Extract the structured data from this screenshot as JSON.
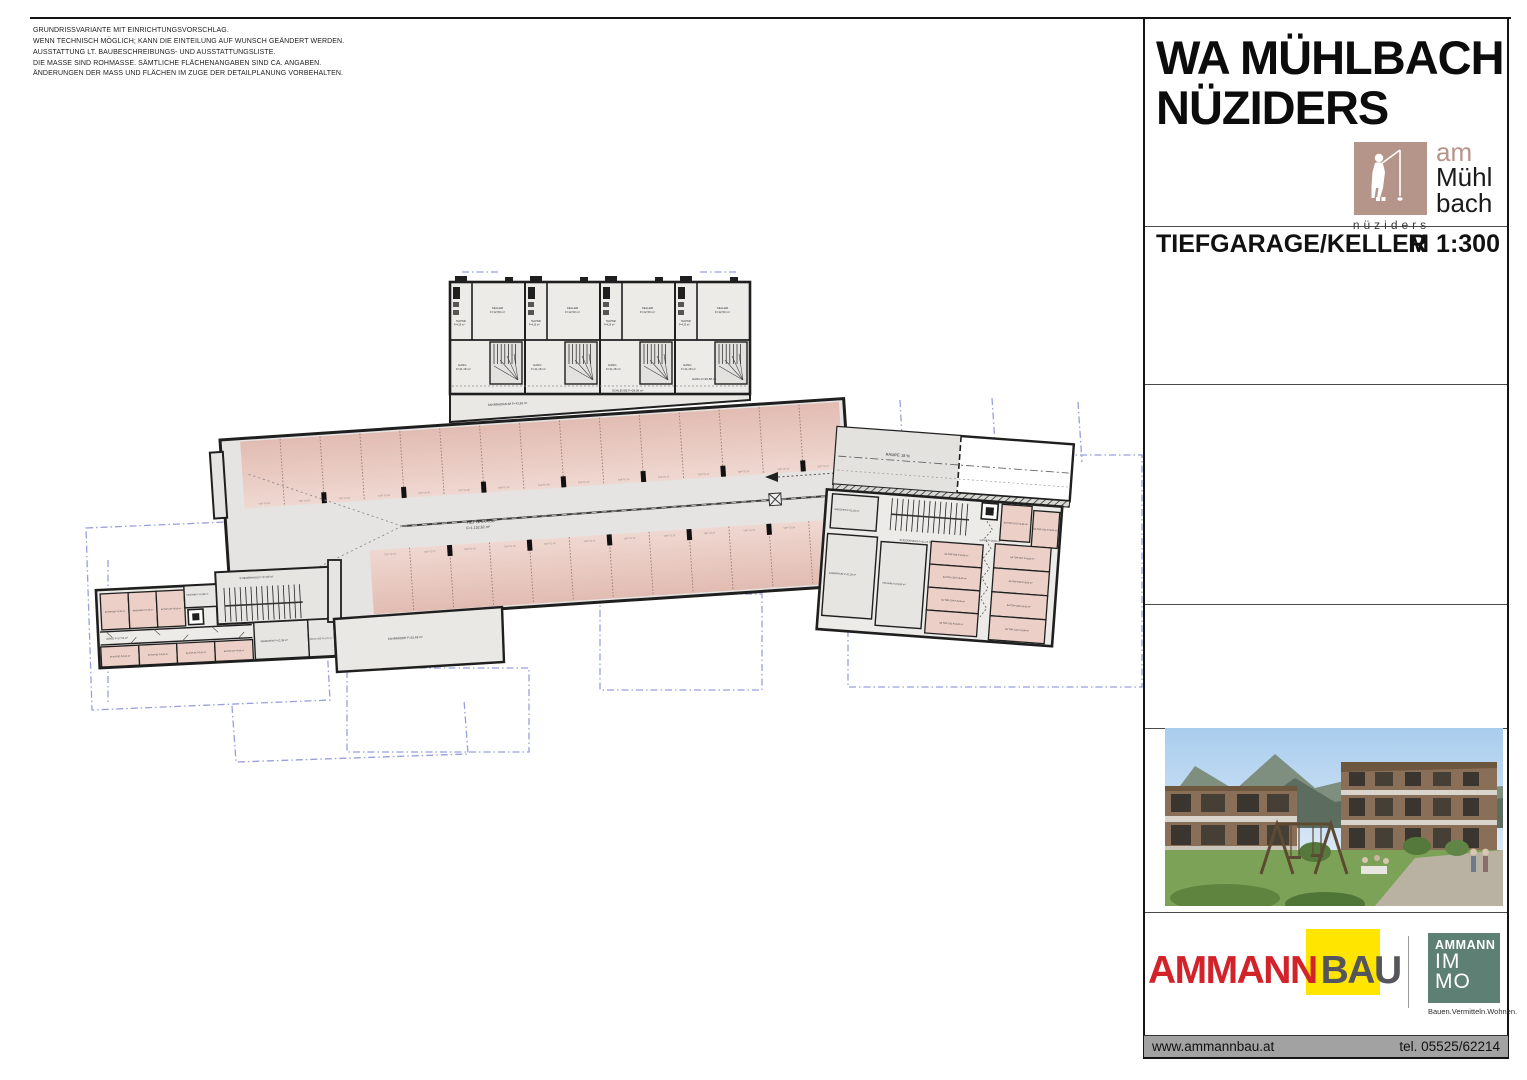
{
  "notes": {
    "lines": [
      "GRUNDRISSVARIANTE MIT EINRICHTUNGSVORSCHLAG.",
      "WENN TECHNISCH MÖGLICH; KANN DIE EINTEILUNG AUF WUNSCH GEÄNDERT WERDEN.",
      "AUSSTATTUNG LT. BAUBESCHREIBUNGS- UND AUSSTATTUNGSLISTE.",
      "DIE MASSE SIND ROHMASSE. SÄMTLICHE FLÄCHENANGABEN SIND CA. ANGABEN.",
      "ÄNDERUNGEN DER MASS UND FLÄCHEN IM ZUGE DER DETAILPLANUNG VORBEHALTEN."
    ]
  },
  "title_block": {
    "project_title_line1": "WA MÜHLBACH",
    "project_title_line2": "NÜZIDERS",
    "plan_name": "TIEFGARAGE/KELLER",
    "scale": "M 1:300",
    "brand": {
      "am": "am",
      "muehl": "Mühl",
      "bach": "bach",
      "sub": "nüziders"
    }
  },
  "logos": {
    "ammannbau": {
      "part1": "AMMANN",
      "part2": "BAU"
    },
    "ammann_immo": {
      "brand": "AMMANN",
      "line1": "IM",
      "line2": "MO",
      "tagline": "Bauen.Vermitteln.Wohnen."
    }
  },
  "footer": {
    "website": "www.ammannbau.at",
    "phone": "tel. 05525/62214"
  },
  "colors": {
    "accent_red": "#d2232a",
    "logo_yellow": "#ffe500",
    "logo_gray": "#54565b",
    "immo_teal": "#5d7f74",
    "brand_brown": "#b5948a",
    "stall_pink": "#e7c9c0",
    "wall": "#222222",
    "overlay_blue": "#98a0dc",
    "footer_gray": "#a2a2a2"
  },
  "plan": {
    "garage_label": "TIEFGARAGE",
    "garage_area": "F=1.132,62 m²",
    "ramp_label": "RAMPE 18 %",
    "schleuse_label": "SCHLEUSE F=29,06 m²",
    "gang_top_label": "GANG F=20,88 m²",
    "fahrradraum_label": "FAHRRADRAUM F=43,93 m²",
    "fahrraeder_label": "FAHRRÄDER F=31,68 m²",
    "top_unit": {
      "technik_name": "TECHNIK",
      "technik_area": "F=4,20 m²",
      "keller_name": "KELLER",
      "keller_area": "F=12,50 m²",
      "gang_name": "GANG",
      "gang_area": "F=11,18 m²"
    },
    "left": {
      "stiegenhaus": "STIEGENHAUS F=27,05 m²",
      "technik": "TECHNIK F=3,38 m²",
      "gang": "GANG F=17,05 m²",
      "waschen": "WASCHEN F=12,39 m²",
      "schleuse": "SCHLEUSE F=2,70 m²",
      "rooms_top": [
        "6A TOP B3 F=5,22 m²",
        "WASCHEN F=4,78 m²",
        "6A TOP A3 F=5,06 m²"
      ],
      "rooms_bottom": [
        "6A TOP B2 F=5,21 m²",
        "6A TOP B1 F=5,23 m²",
        "6A TOP A2 F=5,23 m²",
        "6A TOP A1 F=5,06 m²"
      ]
    },
    "right": {
      "stiegenhaus": "STIEGENHAUS F=21,21 m²",
      "waschen": "WASCHEN F=11,82 m²",
      "kaminraum": "KAMINRAUM F=11,38 m²",
      "technik": "TECHNIK F=31,92 m²",
      "gang": "GANG F=18,50 m²",
      "rooms": [
        "6A TOP C01 F=5,06 m²",
        "6A TOP C02 F=5,02 m²",
        "6A TOP C06 F=5,03 m²",
        "6A TOP C05 F=5,00 m²",
        "6A TOP C04 F=5,00 m²",
        "6A TOP C03 F=5,02 m²",
        "6A TOP C07 F=5,03 m²",
        "6A TOP C08 F=5,00 m²",
        "6A TOP C09 F=5,02 m²",
        "6A TOP C10 F=5,00 m²"
      ]
    },
    "stalls": {
      "prefix": "TOP TG",
      "top_count": 15,
      "bottom_count": 12
    }
  }
}
